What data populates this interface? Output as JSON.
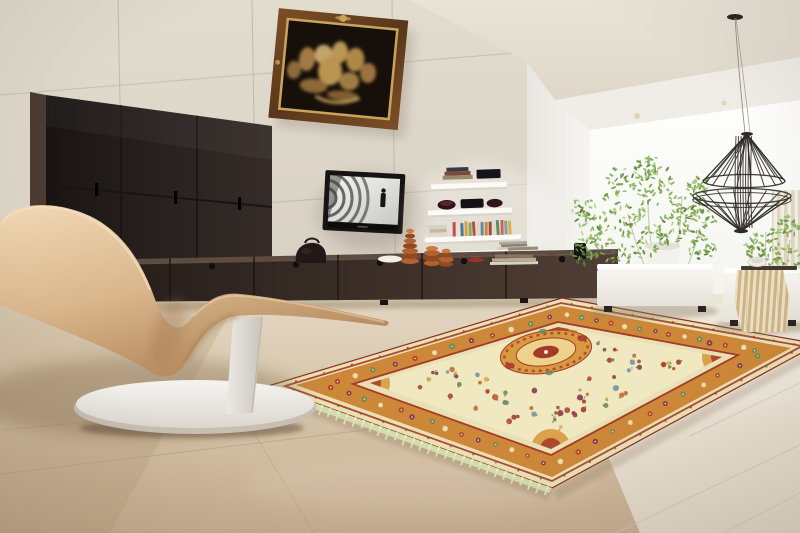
{
  "scene": {
    "type": "interior-photograph",
    "setting": "modern minimalist living room",
    "objects": [
      "oriental persian rug with cream field, orange floral border, gold medallion and pale green fringe",
      "beige leather wave chaise lounge on white oval pedestal base",
      "dark espresso six-panel wall cabinet",
      "wall mounted flat screen tv showing spy-film gun barrel scene",
      "baroque bronze relief artwork in burl wood frame with gold fillet",
      "white floating shelves with books, dark bowls and colorful paperbacks",
      "long dark sideboard with drawers, orange ribbed vases, dark leather bag, white dish and stacked books",
      "black wire pendant lamp hanging on thin cables",
      "feathery green indoor plants in white pots by a bright window",
      "two white upholstered ottomans, one with striped tan throw, tray and small bowl",
      "cream curtain panel at right edge",
      "beige tiled wall and glossy beige tile floor"
    ]
  },
  "palette": {
    "wall": "#d6cfc2",
    "wallLight": "#e2dccf",
    "wallGrout": "#b9b0a0",
    "ceiling": "#e9e3d8",
    "ceilingDark": "#ded7c9",
    "soffit": "#f0ede7",
    "whiteWall": "#f6f5f1",
    "whiteWallDark": "#e8e6e0",
    "window": "#fefefc",
    "windowShade": "#f3f3ee",
    "curtainA": "#f3eee2",
    "curtainB": "#ded4bf",
    "cabinet": "#2a2220",
    "cabinetDark": "#191414",
    "cabinetSide": "#4b3b31",
    "consoleDark": "#241c19",
    "consoleLight": "#503f35",
    "consoleTop": "#5d4c41",
    "consoleSeam": "#140f0d",
    "tvBody": "#161413",
    "screenLight": "#f4f4f1",
    "screenDark": "#c9c9c4",
    "screenArc": "#454542",
    "shelf": "#fbfaf7",
    "shelfShadow": "#d9d4ca",
    "floorTop": "#e4d8c4",
    "floorMid": "#d5c4a8",
    "floorBottom": "#c8b092",
    "floorRight": "#f1ece1",
    "grout": "#b3a184",
    "groutLight": "#d2c7b2",
    "rugCream": "#e9e1b3",
    "rugField": "#f0e8c0",
    "rugOrange": "#cd8738",
    "rugRed": "#a43a2a",
    "rugGold": "#d89a40",
    "rugGoldLight": "#ecd28a",
    "rugGreen": "#6d8a57",
    "rugBlue": "#7a93a8",
    "fringe": "#dde3b8",
    "fringeKnot": "#eef2d4",
    "selvedge": "#d6ddac",
    "chaiseLight": "#efd6b2",
    "chaiseMid": "#d9b68c",
    "chaiseDark": "#b08458",
    "chaiseDeep": "#8f6a48",
    "baseLight": "#f5f4f1",
    "baseMid": "#dcd7cd",
    "baseDark": "#c6bfb2",
    "bench": "#f8f6f2",
    "benchShade": "#e6e2da",
    "throwA": "#ecdfc2",
    "throwB": "#cdb488",
    "lamp": "#2e2a26",
    "wire": "#8a857d",
    "potWhite": "#f3f1ec",
    "bagDark": "#221817",
    "vase": "#b4612f",
    "vaseDark": "#8f4a22",
    "vaseLight": "#cd7a40",
    "frameWood": "#7d4e26",
    "frameWoodDark": "#59371b",
    "frameGold": "#caa45a",
    "reliefBg": "#17100a",
    "shadowWarm": "#8a7258"
  },
  "plant": {
    "leaf_colors": [
      "#6f9c44",
      "#85b357",
      "#9bc46c",
      "#5a8538",
      "#78a84b"
    ]
  },
  "rug": {
    "border_motif_colors": [
      "#b5452f",
      "#ead9ae",
      "#6d8a57",
      "#8a3a50"
    ],
    "field_motif_colors": [
      "#b5452f",
      "#a93a2a",
      "#c96a3e",
      "#6d8a57",
      "#7a93a8",
      "#d9b152",
      "#8a3a50"
    ]
  },
  "shelf_books": {
    "spine_colors": [
      "#c94f43",
      "#e8e3da",
      "#4a7a8c",
      "#d9a13e",
      "#8aa86a",
      "#b4543e",
      "#ddd6c8",
      "#6a8aa0",
      "#c9873e",
      "#9a4a3e",
      "#e0d9c9",
      "#5f8a6a",
      "#c96a45",
      "#8a9ab0",
      "#d9b04a"
    ]
  }
}
